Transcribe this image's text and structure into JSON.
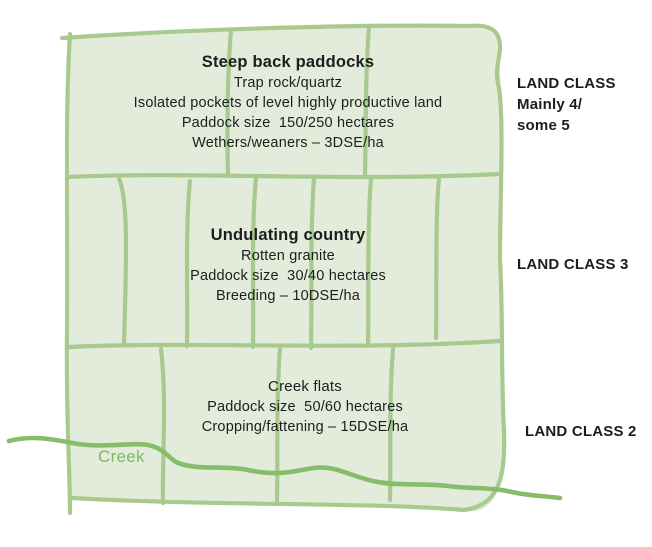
{
  "colors": {
    "paddock_fill": "#e3ecda",
    "fence_line": "#a9ca8f",
    "creek_line": "#86bd6a",
    "creek_text": "#7db95e",
    "text": "#1d1d1d",
    "background": "#ffffff"
  },
  "sections": [
    {
      "id": "steep-back-paddocks",
      "heading": "Steep back paddocks",
      "lines": [
        "Trap rock/quartz",
        "Isolated pockets of level highly productive land",
        "Paddock size  150/250 hectares",
        "Wethers/weaners – 3DSE/ha"
      ],
      "land_class_lines": [
        "LAND CLASS",
        "Mainly 4/",
        "some 5"
      ]
    },
    {
      "id": "undulating-country",
      "heading": "Undulating country",
      "lines": [
        "Rotten granite",
        "Paddock size  30/40 hectares",
        "Breeding – 10DSE/ha"
      ],
      "land_class_lines": [
        "LAND CLASS 3"
      ]
    },
    {
      "id": "creek-flats",
      "heading": "Creek flats",
      "lines": [
        "Paddock size  50/60 hectares",
        "Cropping/fattening – 15DSE/ha"
      ],
      "land_class_lines": [
        "LAND CLASS 2"
      ]
    }
  ],
  "creek": {
    "label": "Creek"
  }
}
